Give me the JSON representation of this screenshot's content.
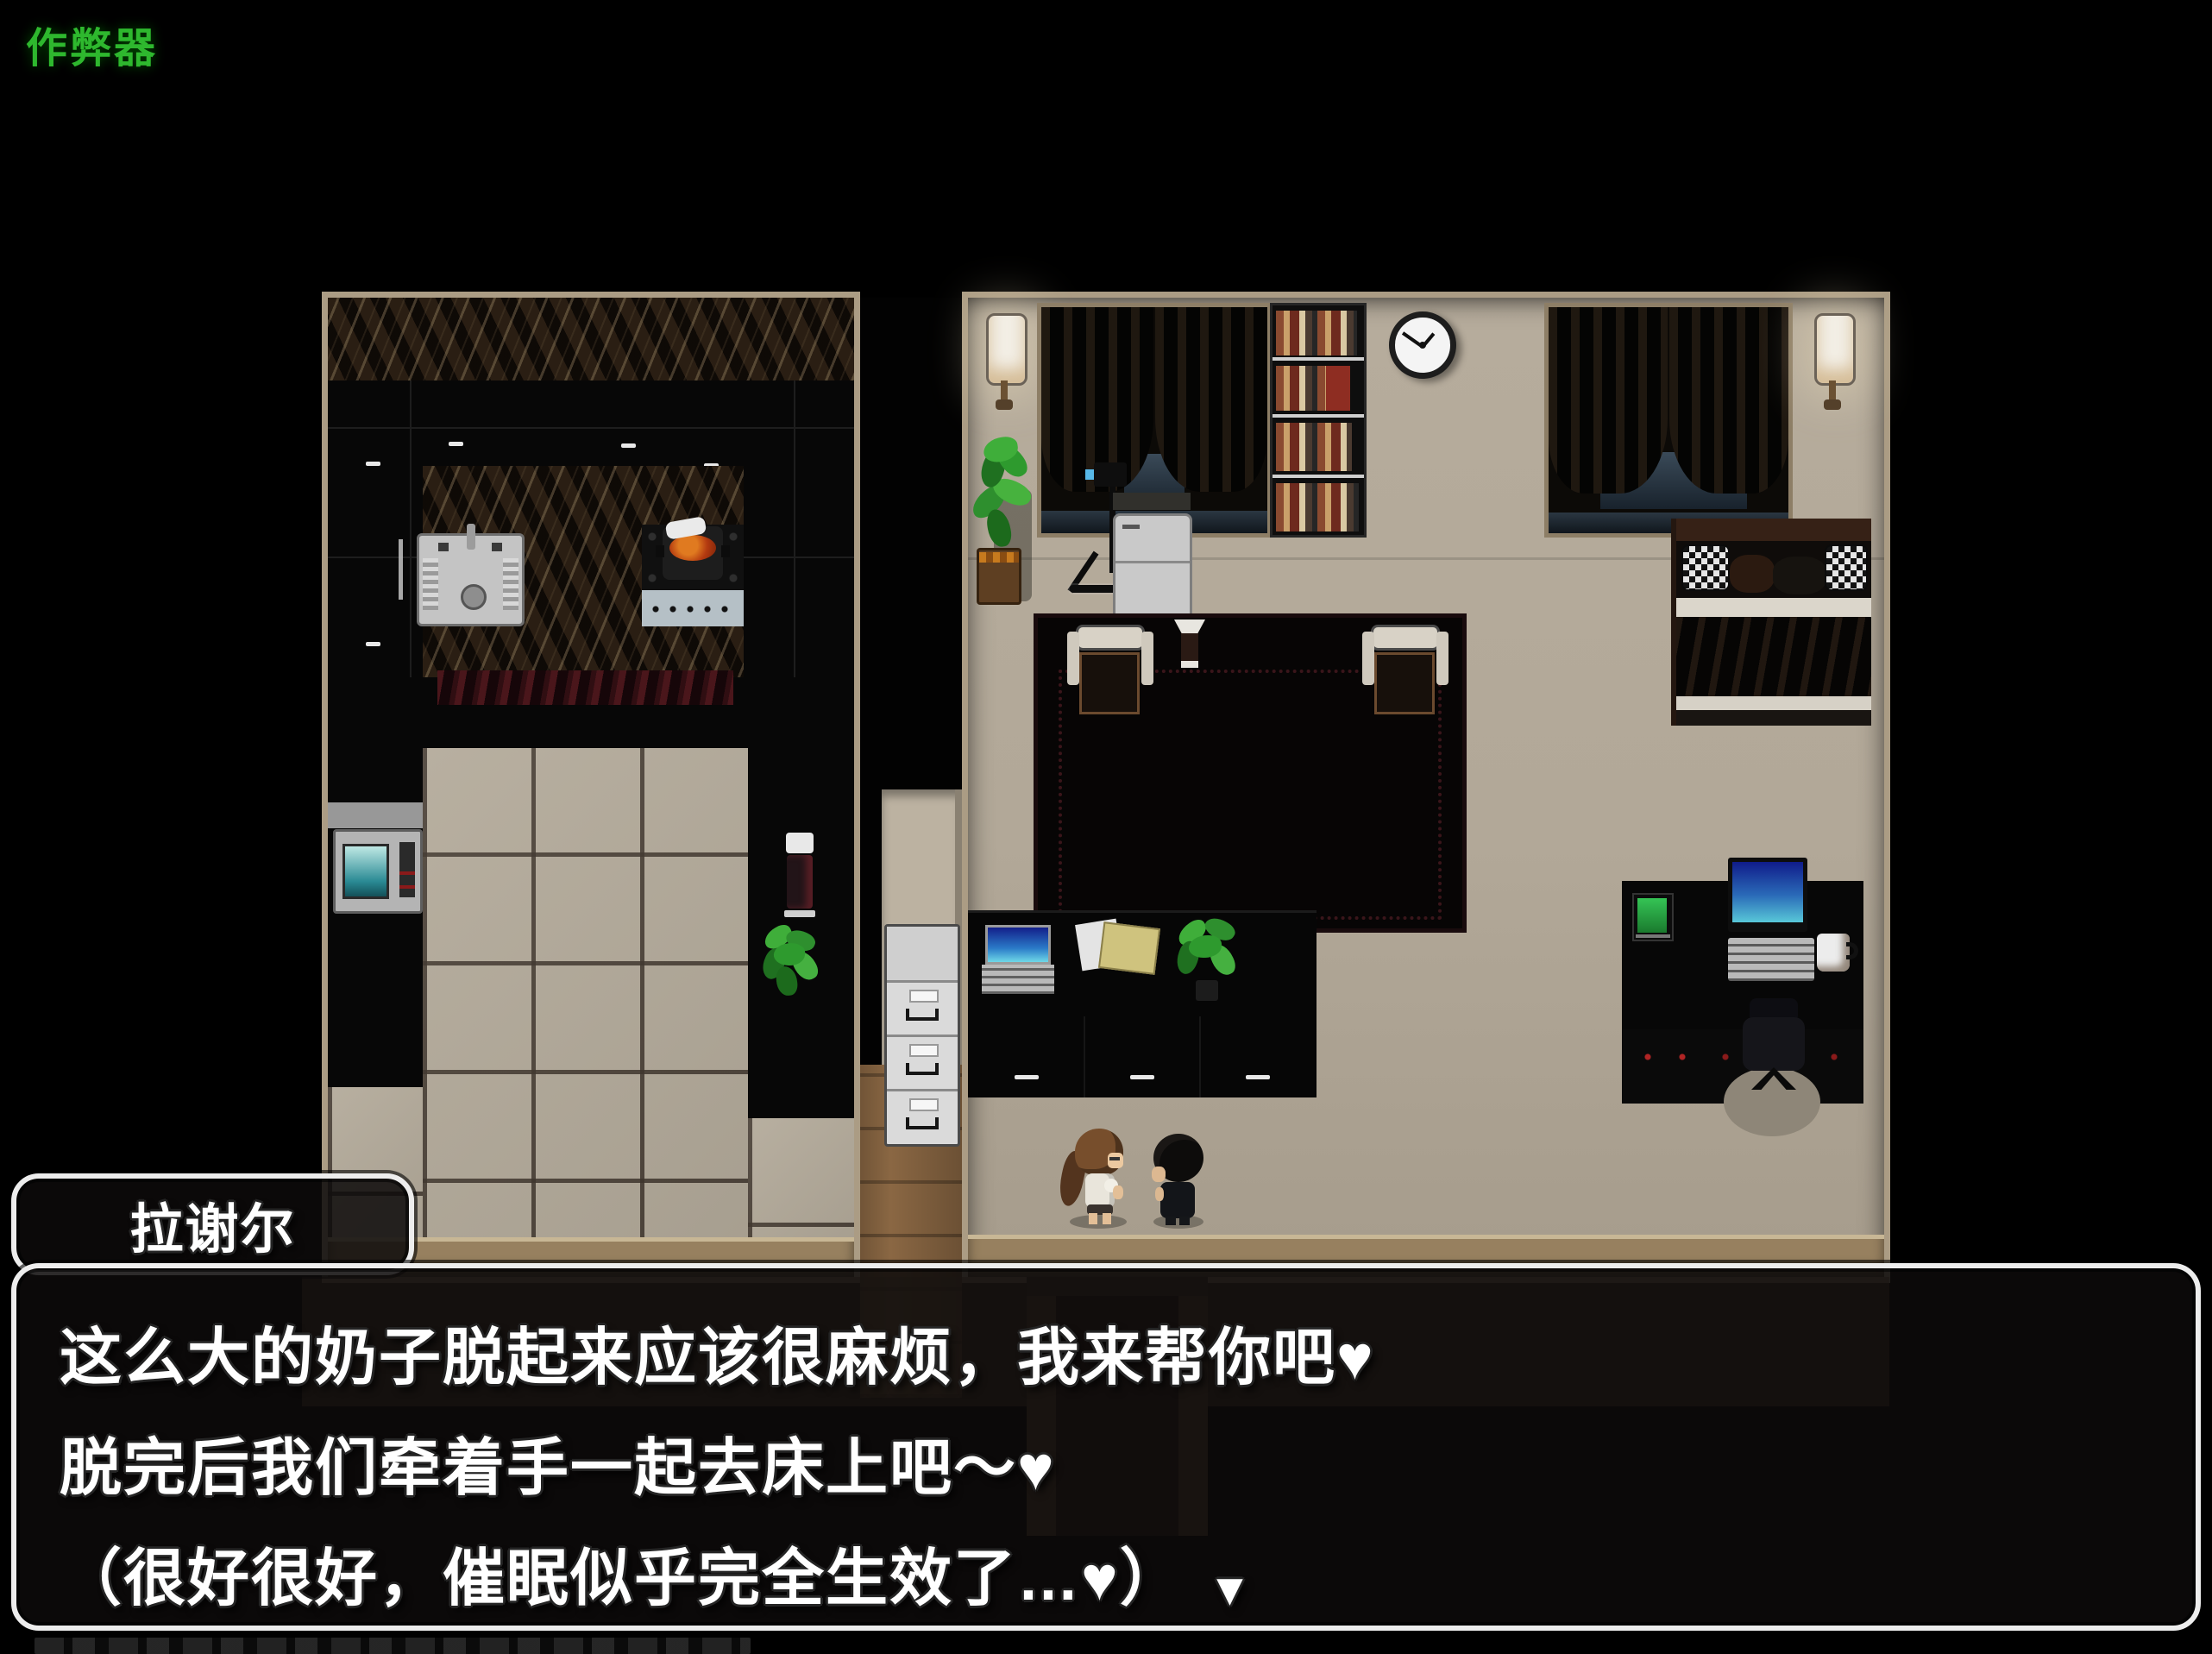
{
  "overlay": {
    "cheat_label": "作弊器"
  },
  "dialogue": {
    "speaker": "拉谢尔",
    "lines": [
      "这么大的奶子脱起来应该很麻烦，我来帮你吧♥",
      "脱完后我们牵着手一起去床上吧～♥",
      "（很好很好，催眠似乎完全生效了…♥）"
    ],
    "continue_indicator": "▼"
  },
  "colors": {
    "cheat_text": "#2eb82e",
    "dialog_border": "#ededed",
    "dialog_text": "#ffffff",
    "wall_trim": "#ab9c84",
    "floor_beige": "#b3a999"
  }
}
